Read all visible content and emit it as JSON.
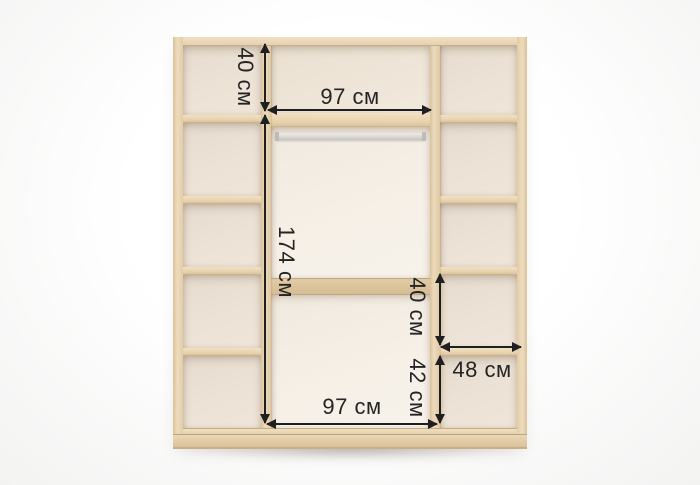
{
  "measurements": {
    "left_top_height": "40 см",
    "center_top_width": "97 см",
    "center_hanging_height": "174 см",
    "right_mid_height": "40 см",
    "right_bottom_height": "42 см",
    "right_width": "48 см",
    "center_bottom_width": "97 см"
  },
  "colors": {
    "wood": "#e7d3b2",
    "wood_dark": "#d9c29c",
    "back_side": "#ece2d5",
    "back_center": "#f6f0e7",
    "rod": "#d8d6d2",
    "annotation": "#1f1f1f",
    "background": "#f3f3f2"
  }
}
